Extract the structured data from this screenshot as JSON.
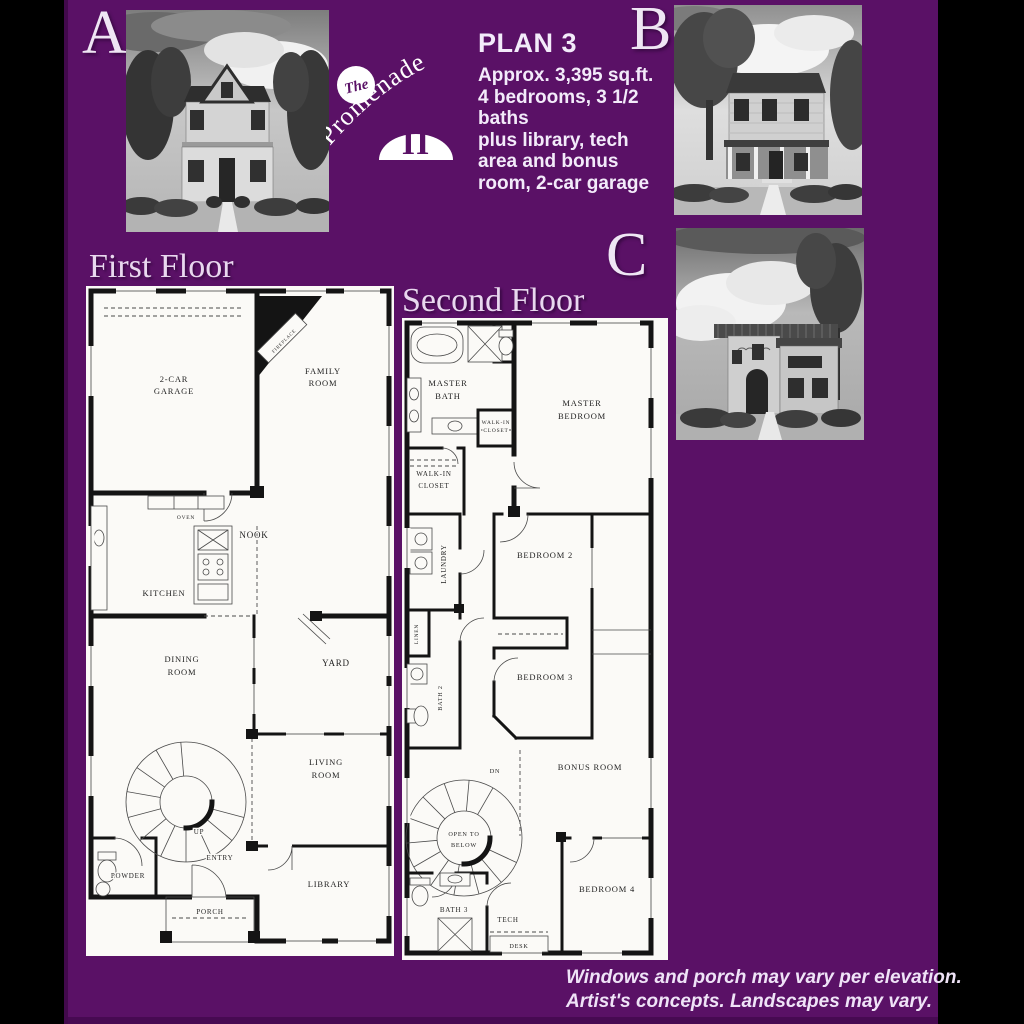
{
  "page": {
    "background": "#000000",
    "stage_background": "#5a1166"
  },
  "elevations": {
    "a": "A",
    "b": "B",
    "c": "C"
  },
  "logo": {
    "the": "The",
    "name": "Promenade",
    "numeral": "II"
  },
  "plan_info": {
    "title": "PLAN 3",
    "line1": "Approx. 3,395 sq.ft.",
    "line2": "4 bedrooms, 3 1/2 baths",
    "line3": "plus library, tech",
    "line4": "area and bonus",
    "line5": "room, 2-car garage"
  },
  "first_floor": {
    "title": "First Floor",
    "labels": {
      "garage": [
        "2-CAR",
        "GARAGE"
      ],
      "family": [
        "FAMILY",
        "ROOM"
      ],
      "fireplace": "FIREPLACE",
      "oven": "OVEN",
      "nook": "NOOK",
      "kitchen": "KITCHEN",
      "dining": [
        "DINING",
        "ROOM"
      ],
      "yard": "YARD",
      "living": [
        "LIVING",
        "ROOM"
      ],
      "up": "UP",
      "powder": "POWDER",
      "entry": "ENTRY",
      "library": "LIBRARY",
      "porch": "PORCH"
    }
  },
  "second_floor": {
    "title": "Second Floor",
    "labels": {
      "master_bath": [
        "MASTER",
        "BATH"
      ],
      "master_bedroom": [
        "MASTER",
        "BEDROOM"
      ],
      "walkin_small": [
        "WALK-IN",
        "CLOSET"
      ],
      "walkin": [
        "WALK-IN",
        "CLOSET"
      ],
      "laundry": "LAUNDRY",
      "bedroom2": "BEDROOM 2",
      "linen": "LINEN",
      "bath2": "BATH 2",
      "bedroom3": "BEDROOM 3",
      "bonus": "BONUS ROOM",
      "dn": "DN",
      "open_below": [
        "OPEN TO",
        "BELOW"
      ],
      "bedroom4": "BEDROOM 4",
      "bath3": "BATH 3",
      "tech": "TECH",
      "desk": "DESK"
    }
  },
  "disclaimer": {
    "line1": "Windows and porch may vary per elevation.",
    "line2": "Artist's concepts. Landscapes may vary."
  }
}
